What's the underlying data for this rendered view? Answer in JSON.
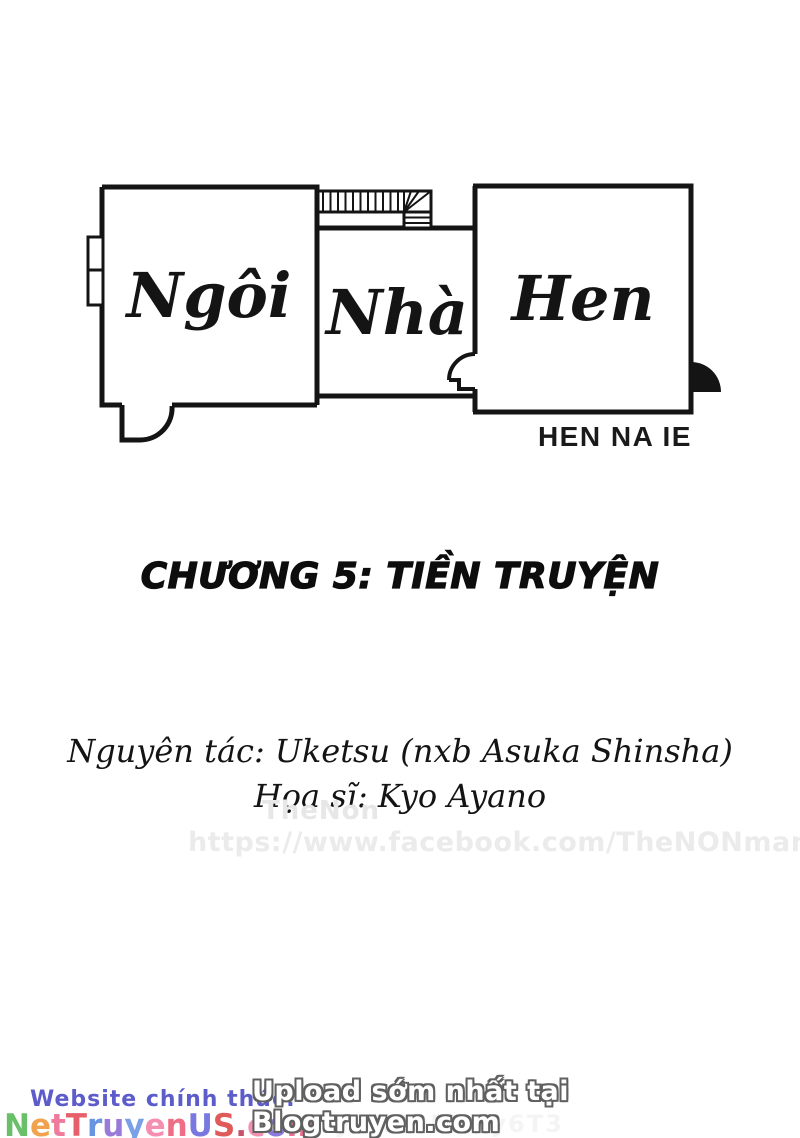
{
  "logo": {
    "word_1": "Ngôi",
    "word_2": "Nhà",
    "word_3": "Hen",
    "romaji": "HEN NA IE",
    "ink_color": "#141414"
  },
  "chapter": {
    "title": "CHƯƠNG 5: TIỀN TRUYỆN"
  },
  "credits": {
    "original_line": "Nguyên tác: Uketsu (nxb Asuka Shinsha)",
    "artist_line": "Họa sĩ: Kyo Ayano"
  },
  "watermarks": {
    "group": "TheNon",
    "facebook": "https://www.facebook.com/TheNONmanga",
    "faint_code": "xwvnyBR29EBUy6T3"
  },
  "footer": {
    "official_label": "Website chính thức:",
    "official_color": "#5c5ccb",
    "site": {
      "text": "NetTruyenUS.com",
      "letters": [
        {
          "ch": "N",
          "color": "#6abf69"
        },
        {
          "ch": "e",
          "color": "#f0a24e"
        },
        {
          "ch": "t",
          "color": "#ef7a9b"
        },
        {
          "ch": "T",
          "color": "#e85f6c"
        },
        {
          "ch": "r",
          "color": "#6a93e0"
        },
        {
          "ch": "u",
          "color": "#9a7ad8"
        },
        {
          "ch": "y",
          "color": "#7aa0e8"
        },
        {
          "ch": "e",
          "color": "#f48fb1"
        },
        {
          "ch": "n",
          "color": "#ee6f85"
        },
        {
          "ch": "U",
          "color": "#7878e0"
        },
        {
          "ch": "S",
          "color": "#e05a5a"
        },
        {
          "ch": ".",
          "color": "#c7536b"
        },
        {
          "ch": "c",
          "color": "#f48fb1"
        },
        {
          "ch": "o",
          "color": "#8a7ae0"
        },
        {
          "ch": "m",
          "color": "#ee6f8f"
        }
      ]
    },
    "upload_note": "Upload sớm nhất tại Blogtruyen.com"
  }
}
